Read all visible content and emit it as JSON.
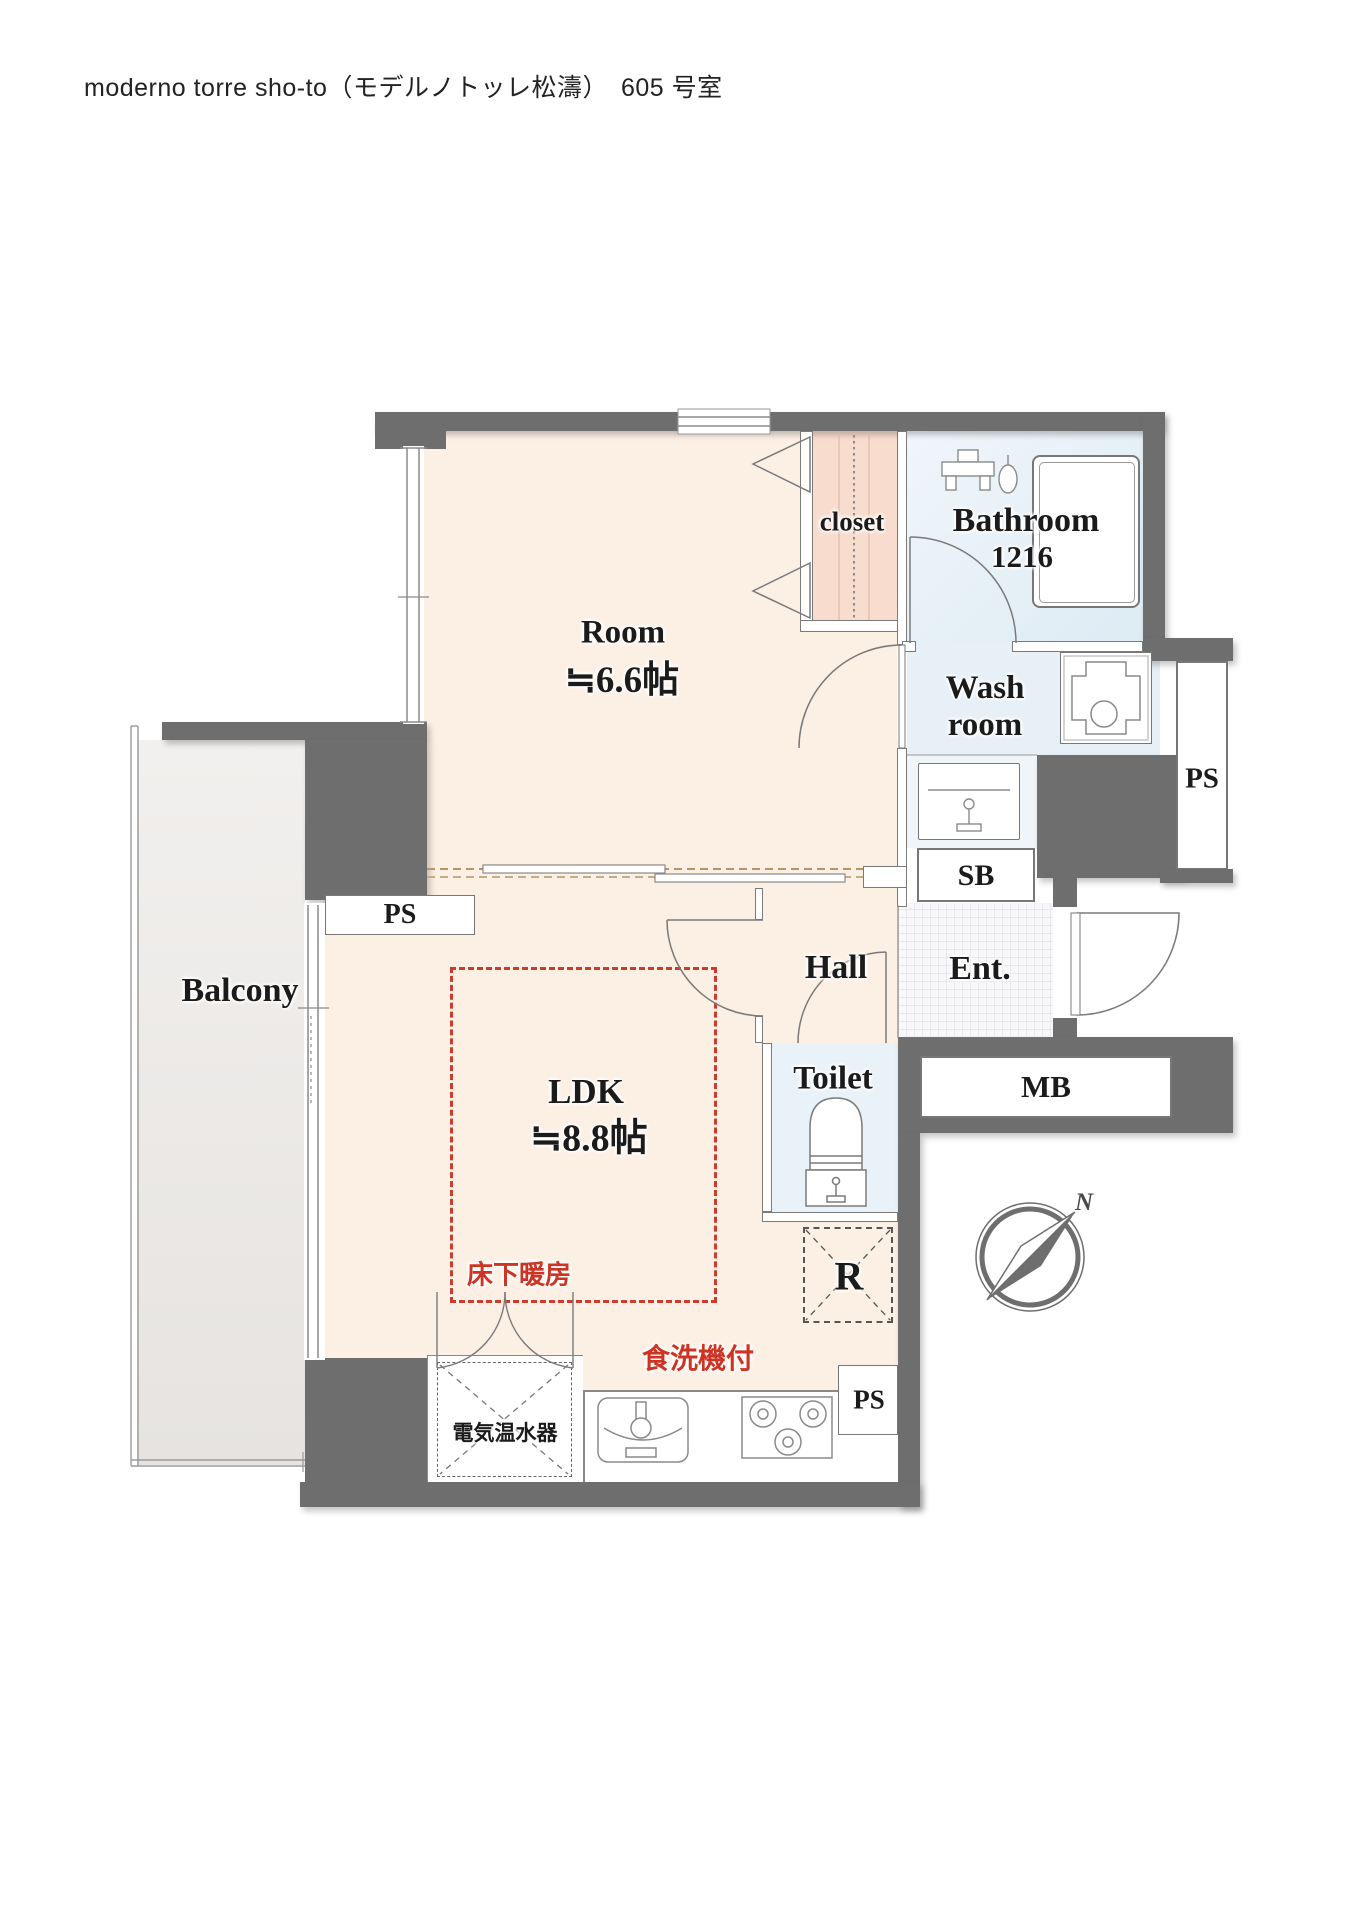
{
  "page": {
    "title": "moderno torre sho-to（モデルノトッレ松濤）　605 号室"
  },
  "plan": {
    "rooms": {
      "room": {
        "label": "Room",
        "size": "≒6.6帖"
      },
      "ldk": {
        "label": "LDK",
        "size": "≒8.8帖"
      },
      "closet": {
        "label": "closet"
      },
      "bathroom": {
        "label": "Bathroom",
        "size": "1216"
      },
      "washroom": {
        "line1": "Wash",
        "line2": "room"
      },
      "toilet": {
        "label": "Toilet"
      },
      "hall": {
        "label": "Hall"
      },
      "entrance": {
        "label": "Ent."
      },
      "balcony": {
        "label": "Balcony"
      }
    },
    "shafts": {
      "ps_right": "PS",
      "ps_ldk": "PS",
      "ps_kitchen": "PS",
      "sb": "SB",
      "mb": "MB",
      "refrigerator": "R"
    },
    "annotations": {
      "floor_heating": "床下暖房",
      "dishwasher": "食洗機付",
      "water_heater": "電気温水器",
      "compass_north": "N"
    },
    "colors": {
      "wall": "#6e6e6e",
      "room_floor": "#fcefe4",
      "closet_floor": "#f8dcce",
      "wet_floor": "#e8f1f8",
      "accent_red": "#cd3b2c",
      "balcony_floor": "#efedeb"
    }
  }
}
